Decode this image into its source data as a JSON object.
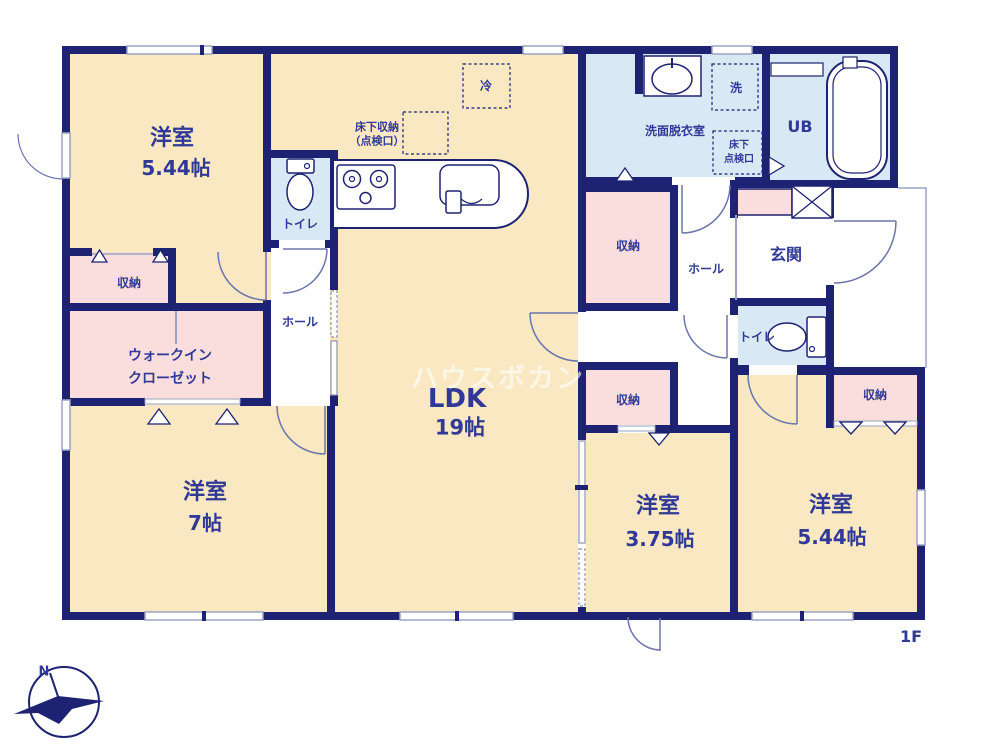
{
  "floor_label": "1F",
  "watermark_text": "ハウスボカン",
  "compass": {
    "north": "N"
  },
  "palette": {
    "wall": "#1e2272",
    "room_floor": "#f9e8c2",
    "storage_floor": "#fadddd",
    "wet_area_floor": "#d9e8f5",
    "text": "#303a96",
    "window_stroke": "#9aa3c4"
  },
  "rooms": {
    "bedroom_top_left": {
      "label": "洋室",
      "size": "5.44帖"
    },
    "bedroom_bottom_left": {
      "label": "洋室",
      "size": "7帖"
    },
    "bedroom_bottom_middle": {
      "label": "洋室",
      "size": "3.75帖"
    },
    "bedroom_bottom_right": {
      "label": "洋室",
      "size": "5.44帖"
    },
    "ldk": {
      "label": "LDK",
      "size": "19帖"
    },
    "walk_in_closet": {
      "label_line1": "ウォークイン",
      "label_line2": "クローゼット"
    },
    "washroom": {
      "label": "洗面脱衣室"
    },
    "unit_bath": {
      "label": "UB"
    },
    "entrance": {
      "label": "玄関"
    },
    "hall_left": {
      "label": "ホール"
    },
    "hall_right": {
      "label": "ホール"
    },
    "toilet_left": {
      "label": "トイレ"
    },
    "toilet_right": {
      "label": "トイレ"
    },
    "storage_top_left": {
      "label": "収納"
    },
    "storage_mid_upper": {
      "label": "収納"
    },
    "storage_mid_lower": {
      "label": "収納"
    },
    "storage_bottom_right": {
      "label": "収納"
    },
    "underfloor_storage": {
      "label_line1": "床下収納",
      "label_line2": "（点検口）"
    },
    "underfloor_hatch": {
      "label_line1": "床下",
      "label_line2": "点検口"
    },
    "refrigerator_space": {
      "label": "冷"
    },
    "washer_space": {
      "label": "洗"
    }
  }
}
